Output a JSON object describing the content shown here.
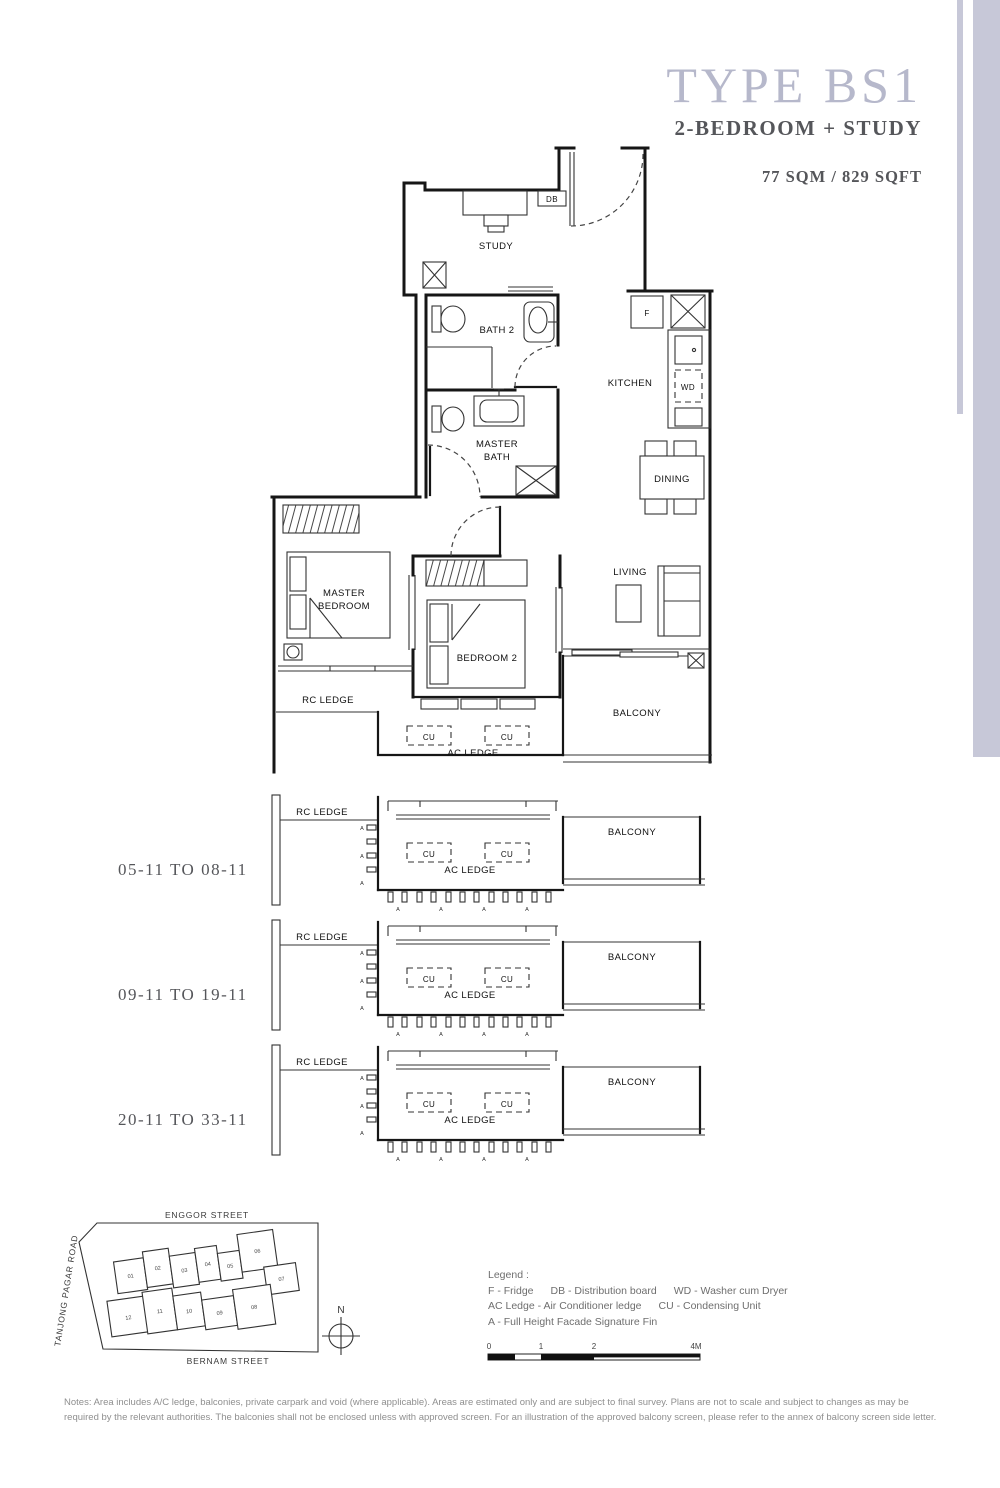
{
  "header": {
    "type_title": "TYPE BS1",
    "subtitle": "2-BEDROOM + STUDY",
    "area": "77 SQM / 829 SQFT"
  },
  "colors": {
    "accent_bar": "#c7c8d8",
    "title_text": "#b6b8cb",
    "dark_text": "#55565a",
    "highlight_unit": "#c3c4d6"
  },
  "plan": {
    "rooms": {
      "study": "STUDY",
      "bath2": "BATH 2",
      "master_bath": [
        "MASTER",
        "BATH"
      ],
      "kitchen": "KITCHEN",
      "dining": "DINING",
      "living": "LIVING",
      "master_bedroom": [
        "MASTER",
        "BEDROOM"
      ],
      "bedroom2": "BEDROOM 2",
      "balcony": "BALCONY"
    },
    "fixtures": {
      "fridge": "F",
      "db": "DB",
      "wd": "WD",
      "cu": "CU"
    },
    "ledges": {
      "rc": "RC LEDGE",
      "ac": "AC LEDGE"
    },
    "fin_marker": "A"
  },
  "stacks": [
    {
      "label": "05-11 TO 08-11"
    },
    {
      "label": "09-11 TO 19-11"
    },
    {
      "label": "20-11 TO 33-11"
    }
  ],
  "site_map": {
    "streets": {
      "top": "ENGGOR STREET",
      "left": "TANJONG PAGAR ROAD",
      "bottom": "BERNAM STREET"
    },
    "compass_north": "N",
    "units": [
      "01",
      "02",
      "03",
      "04",
      "05",
      "06",
      "07",
      "08",
      "09",
      "10",
      "11",
      "12"
    ],
    "highlighted_unit": "11"
  },
  "legend": {
    "title": "Legend :",
    "items": [
      "F - Fridge",
      "DB - Distribution board",
      "WD - Washer cum Dryer",
      "AC Ledge - Air Conditioner ledge",
      "CU - Condensing Unit",
      "A - Full Height Facade Signature Fin"
    ]
  },
  "scale_bar": {
    "ticks": [
      "0",
      "1",
      "2",
      "4M"
    ]
  },
  "notes": "Notes: Area includes A/C ledge, balconies, private carpark and void (where applicable). Areas are estimated only and are subject to final survey. Plans are not to scale and subject to changes as may be required by the relevant authorities. The balconies shall not be enclosed unless with approved screen. For an illustration of the approved balcony screen, please refer to the annex of balcony screen side letter."
}
